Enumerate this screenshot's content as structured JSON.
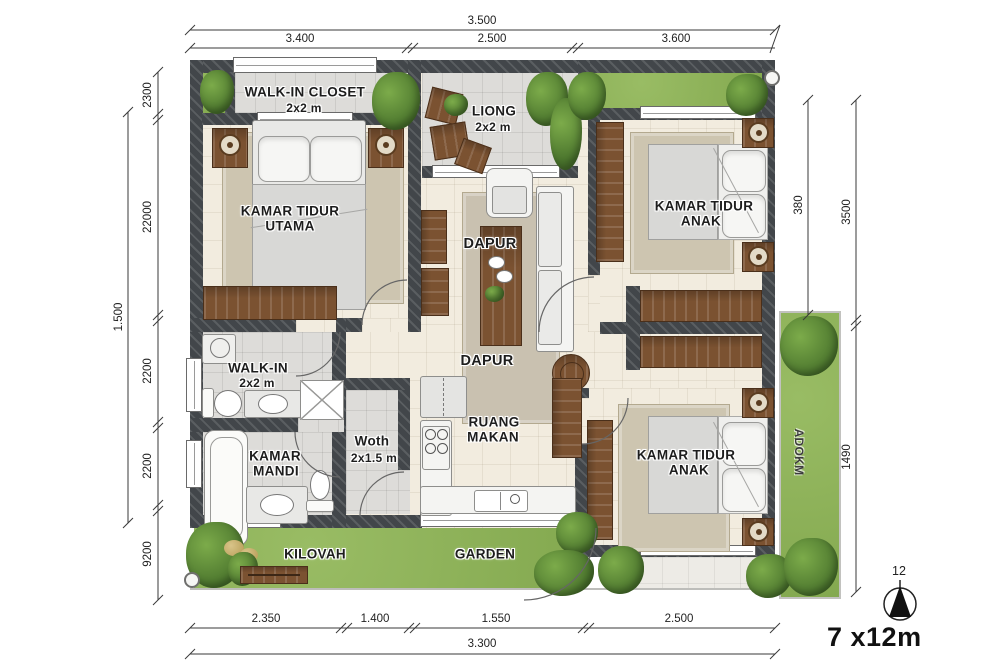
{
  "title": "House floor plan",
  "scale": {
    "label": "7 x12m",
    "north": "12"
  },
  "dims": {
    "top": {
      "overall": "3.500",
      "segments": [
        "3.400",
        "2.500",
        "3.600"
      ]
    },
    "bottom": {
      "overall": "3.300",
      "segments": [
        "2.350",
        "1.400",
        "1.550",
        "2.500"
      ]
    },
    "left": {
      "overall": "1.500",
      "segments": [
        "2300",
        "22000",
        "2200",
        "2200",
        "9200"
      ]
    },
    "right": {
      "inner": "380",
      "outer": [
        "3500",
        "1490"
      ]
    }
  },
  "rooms": {
    "walk_in_closet": {
      "name": "WALK-IN CLOSET",
      "size": "2x2 m"
    },
    "liong": {
      "name": "LIONG",
      "size": "2x2 m"
    },
    "master_bedroom": {
      "line1": "KAMAR TIDUR",
      "line2": "UTAMA"
    },
    "kids_bedroom_top": {
      "line1": "KAMAR TIDUR",
      "line2": "ANAK"
    },
    "living": {
      "name": "DAPUR"
    },
    "hall": {
      "name": "DAPUR"
    },
    "walk_in": {
      "name": "WALK-IN",
      "size": "2x2 m"
    },
    "bathroom": {
      "line1": "KAMAR",
      "line2": "MANDI"
    },
    "woth": {
      "name": "Woth",
      "size": "2x1.5 m"
    },
    "dining": {
      "line1": "RUANG",
      "line2": "MAKAN"
    },
    "kids_bedroom_bottom": {
      "line1": "KAMAR TIDUR",
      "line2": "ANAK"
    },
    "kilovah": {
      "name": "KILOVAH"
    },
    "garden": {
      "name": "GARDEN"
    },
    "side_garden": {
      "name": "ADOKM"
    }
  },
  "colors": {
    "wall": "#42464a",
    "floor": "#f2ecdf",
    "tile": "#dddcd9",
    "garden": "#8cb159",
    "wood": "#7b5231",
    "rug": "#cdc5b0"
  }
}
